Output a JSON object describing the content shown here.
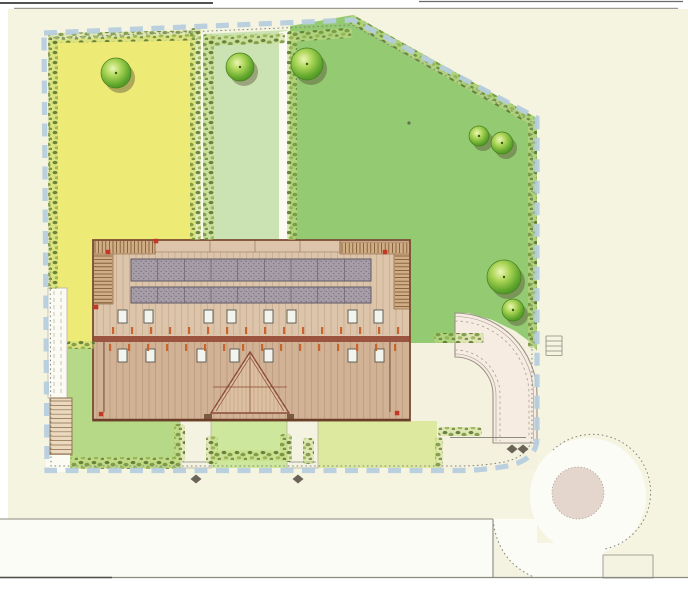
{
  "meta": {
    "width": 688,
    "height": 600,
    "kind": "scanned landscape site plan, no visible text"
  },
  "palette": {
    "page": "#ffffff",
    "paper": "#f5f4e1",
    "street_white": "#fcfcf6",
    "lawn_yellow": "#eeea76",
    "lawn_light_strip": "#cbe3b2",
    "lawn_green": "#93ca72",
    "lawn_lower_left": "#b6d987",
    "lawn_mid": "#cde79d",
    "lawn_pale": "#dce99e",
    "cream_zone": "#f4f1de",
    "hedge_bg": "#c9dc86",
    "hedge_dot_dark": "#55722a",
    "hedge_dot_mid": "#6f8f3a",
    "hedge_dot_light": "#8fae4c",
    "dash_blue": "#b6cddd",
    "pencil": "#8a8a80",
    "roof_upper": "#dcc5ab",
    "roof_lower": "#d2b295",
    "rafter": "#b2906f",
    "rafter_lower": "#a8866b",
    "ridge": "#9a5440",
    "hatch_fill": "#cfae86",
    "hatch_line": "#7a5230",
    "panel_fill": "#a79ea9",
    "panel_border": "#5f5864",
    "panel_dot": "#776e80",
    "skylight_fill": "#f4f4ee",
    "skylight_border": "#55554a",
    "tick_orange": "#c8652e",
    "red_mark": "#c23824",
    "gable_fill": "#dcc0a2",
    "door": "#7a5a42",
    "path_fill": "#f7ece2",
    "path_edge": "#9a9288",
    "island": "#e4d6cd",
    "curb_fill": "#f4f3e1",
    "white_strip": "#fbfbf3",
    "stairs_fill": "#ead9bf",
    "diamond": "#6b6258",
    "tree_light": "#ecf6b4",
    "tree_mid": "#a9d455",
    "tree_deep": "#5ea52b",
    "tree_dark": "#3f8a1f",
    "tree_ring": "#467f1d",
    "tree_shadow": "rgba(85,78,52,0.42)",
    "tree_dot": "#3a5a14",
    "green_dot": "#667055"
  },
  "geometry": {
    "page": "M0,0 H688 V600 H0 Z",
    "paper": "M8,9 H688 V578 H8 Z",
    "scan_top_dark": "M0,3 H213",
    "scan_top_right": "M419,1.5 H683",
    "scan_top_gray": "M14,8.5 H678",
    "street": "M0,519 H537 V577 H0 Z",
    "roundabout": "M530,496 a58,58 0 1 0 116,0 a58,58 0 1 0 -116,0",
    "round_open": "M536,543 H604 V577 H536 Z",
    "fillet_wedge": "M493,520 Q498,562 534,577 L493,577 Z",
    "fillet_arc": "M493,520 Q498,562 534,577",
    "roundabout_arc": "M553,450 A58 58 0 1 1 605,549",
    "curb_se": "M603,555 H653 V578 H603 Z",
    "island": "M552,493 a26,26 0 1 0 52,0 a26,26 0 1 0 -52,0",
    "street_edges": "M0,519 H493 M493,519 V577 M481,420 V437",
    "street_bottom": "M0,577.5 H688",
    "street_bottom_dark": "M0,577.5 H112",
    "parcels": {
      "yellow": "50,40 197,34 197,240 95,240 95,348 50,348",
      "light_strip": "203,34 287,30 287,240 203,240",
      "gap_left": "196,34 203,34 203,240 196,240",
      "gap_right": "279,32 287,31 287,240 279,240",
      "green": "290,26 353,15 537,118 537,351 530,342 515,331 492,320 468,313 455,313 455,343 410,343 410,240 290,240",
      "cream_se": "410,343 455,343 455,313 468,313 492,320 515,331 530,342 537,351 537,470 410,470",
      "lower_left": "50,348 95,348 95,421 180,421 180,468 50,468"
    },
    "mid_lawn": "M211,421 H287 V468 H211 Z",
    "right_lawn": "M318,421 H437 V468 H318 Z",
    "walk_left": "M180,421 H211 V468 H180 Z",
    "walk_right": "M287,421 H318 V468 H287 Z",
    "walk_marks": "M182,462 H210 M289,462 H316",
    "west_strip": "M48,288 H67 V398 H48 Z",
    "west_dashes": "M54,291 V395 M61,291 V395",
    "west_stairs": "M50,398 H72 V455 H50 Z",
    "west_white_low": "M46,455 H70 V472 H46 Z",
    "driveway_body": "M455,313 A82 82 0 0 1 537,395 L537,443 L493,443 L493,395 A38 38 0 0 0 455,357 Z",
    "kerb_outer": "M455,316.5 A78.5 78.5 0 0 1 533.5,395 L533.5,441",
    "kerb_outer_dash": "M455,321 A74 74 0 0 1 529,395 L529,438",
    "kerb_inner": "M455,354 A41 41 0 0 1 496,395 L496,441",
    "kerb_inner_dash": "M455,350 A45 45 0 0 1 500,395 L500,441",
    "driveway_end": "M450,437.5 H526",
    "east_steps": "M546,336 H562 M546,341 H562 M546,346 H562 M546,351 H562 M546,355.5 H562 M546,336 V355.5 M562,336 V355.5",
    "roof_upper": "M93,240 H410 V337 H93 Z",
    "roof_lower": "M93,337 H410 V420.5 H93 Z",
    "ridge": "M93,336 H410 V342 H93 Z",
    "top_band": "M155,240 H340 V252 H155 Z",
    "band_dividers": "M210,240 V252 M255,240 V252 M300,240 V252",
    "hatch_bands": "M93,240 H155 V254 H93 Z M93,254 H113 V304 H93 Z M340,242 H410 V254 H340 Z M394,254 H410 V309 H394 Z",
    "roof_outline": "M93,240 H410 V420.5 H93 Z",
    "roof_bottom_line": "M93,420 H410",
    "roof_dark_lines": "M104,342 V412 M390,342 V412",
    "gable": {
      "outline": "250,352 289,413 211,413",
      "inner": "M250,353 V413 M250,357 L216,411 M250,357 L284,411 M213,387 H287",
      "hatch": {
        "x1": 214,
        "x2": 286,
        "step": 4,
        "y1": 354,
        "y2": 412
      }
    },
    "doors": "M204,414 h8 v6 h-8 Z M287,414 h7 v5 h-7 Z",
    "green_dot": "M407.4,123 a1.6,1.6 0 1 0 3.2,0 a1.6,1.6 0 1 0 -3.2,0",
    "boundary_pencil": "M49,38 L210,31 L352,25 L532,122 L532,434 Q532,456 504,462 Q482,466 458,466 L51,466 Z",
    "boundary_dash": "M44,33 L210,26 L353,20 L537,118 L537,438 Q537,460 507,466 Q484,470.5 456,470.5 L47,470.5 Z"
  },
  "collections": {
    "trees": [
      [
        116,
        73,
        15
      ],
      [
        240,
        67,
        14
      ],
      [
        307,
        64,
        16
      ],
      [
        479,
        136,
        10
      ],
      [
        502,
        143,
        11
      ],
      [
        504,
        277,
        17
      ],
      [
        513,
        310,
        11
      ]
    ],
    "hedges": [
      [
        48,
        33,
        150,
        10,
        -1
      ],
      [
        48,
        36,
        10,
        253,
        0
      ],
      [
        190,
        28,
        11,
        212,
        0
      ],
      [
        203,
        34,
        11,
        206,
        0
      ],
      [
        287,
        31,
        10,
        209,
        0
      ],
      [
        205,
        36,
        80,
        10,
        -2
      ],
      [
        290,
        32,
        62,
        10,
        -4
      ],
      [
        352,
        14,
        209,
        9,
        29.4
      ],
      [
        528,
        120,
        9,
        228,
        0
      ],
      [
        70,
        457,
        112,
        12,
        0
      ],
      [
        212,
        450,
        75,
        11,
        0
      ],
      [
        174,
        424,
        11,
        38,
        0
      ],
      [
        206,
        436,
        12,
        28,
        0
      ],
      [
        280,
        434,
        12,
        28,
        0
      ],
      [
        303,
        438,
        11,
        26,
        0
      ],
      [
        435,
        437,
        8,
        31,
        0
      ],
      [
        438,
        427,
        44,
        9,
        0
      ],
      [
        67,
        341,
        28,
        8,
        0
      ],
      [
        434,
        333,
        50,
        10,
        0
      ]
    ],
    "hatch": [
      [
        93,
        240,
        62,
        14,
        "v"
      ],
      [
        93,
        254,
        20,
        50,
        "h"
      ],
      [
        340,
        242,
        70,
        12,
        "v"
      ],
      [
        394,
        254,
        16,
        55,
        "h"
      ]
    ],
    "panels": {
      "x": 131,
      "w": 240,
      "segs": 9,
      "rows": [
        [
          259,
          22
        ],
        [
          287,
          16
        ]
      ]
    },
    "skylights": {
      "w": 9,
      "h": 13,
      "rows": [
        [
          310,
          [
            118,
            144,
            204,
            227,
            264,
            287,
            348,
            374
          ]
        ],
        [
          349,
          [
            118,
            146,
            197,
            230,
            264,
            348,
            375
          ]
        ]
      ]
    },
    "ticks": {
      "h": 7,
      "w": 2.2,
      "rows": [
        [
          327,
          [
            112,
            131,
            150,
            169,
            188,
            207,
            226,
            245,
            264,
            283,
            302,
            321,
            340,
            359,
            378,
            397
          ]
        ],
        [
          344,
          [
            109,
            128,
            147,
            166,
            185,
            204,
            223,
            242,
            261,
            280,
            299,
            318,
            337,
            356,
            375,
            394
          ]
        ]
      ]
    },
    "red_marks": [
      [
        108,
        252
      ],
      [
        156,
        241
      ],
      [
        385,
        252
      ],
      [
        96,
        307
      ],
      [
        101,
        414
      ],
      [
        397,
        413
      ]
    ],
    "diamonds": [
      [
        196,
        479
      ],
      [
        298,
        479
      ],
      [
        512,
        449
      ],
      [
        523,
        449
      ]
    ],
    "rafters": {
      "x1": 97,
      "x2": 408,
      "step": 6.5,
      "upper": [
        242.5,
        335
      ],
      "lower": [
        341.5,
        418.5
      ]
    },
    "stairs_rungs": {
      "x1": 50,
      "x2": 72,
      "y1": 401,
      "y2": 454,
      "step": 4.4
    }
  }
}
